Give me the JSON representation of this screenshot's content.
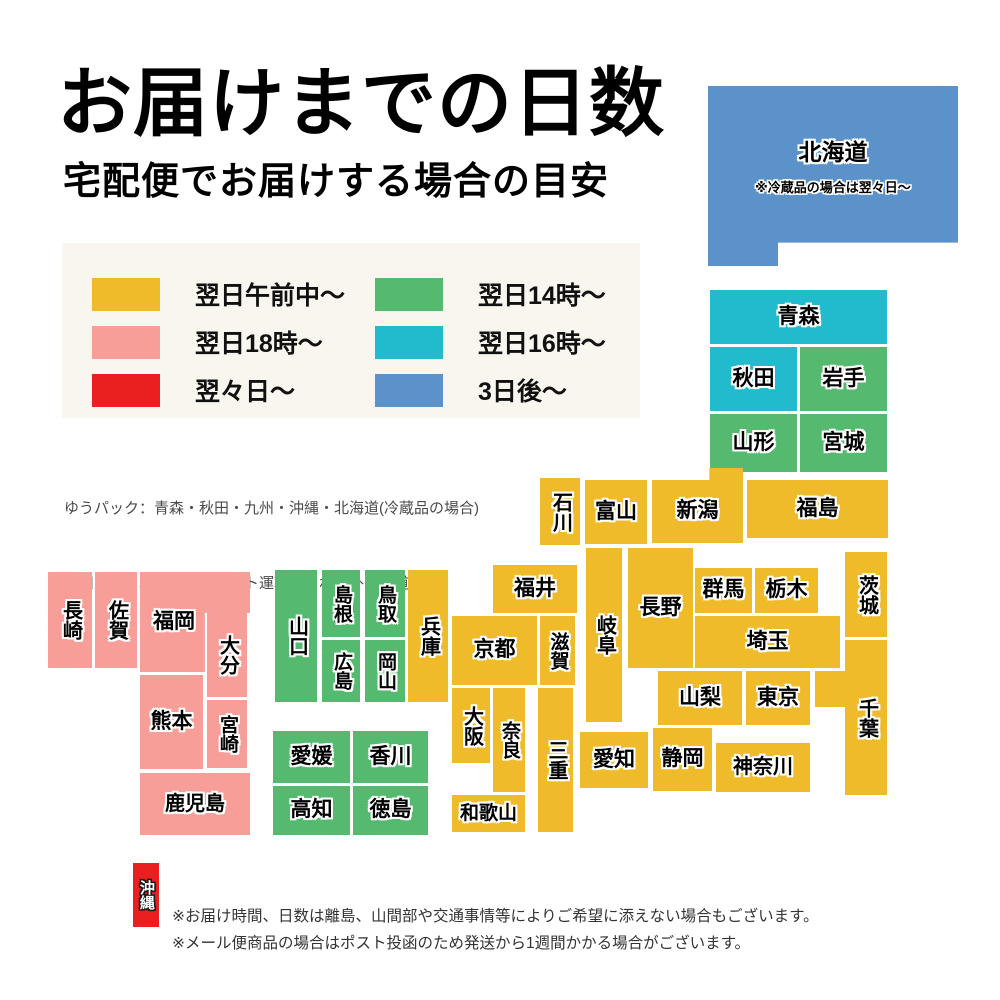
{
  "header": {
    "title": "お届けまでの日数",
    "subtitle": "宅配便でお届けする場合の目安"
  },
  "colors": {
    "yellow": "#EFBB2B",
    "pink": "#F79E99",
    "red": "#E9201F",
    "green": "#55BA6F",
    "cyan": "#22BACD",
    "blue": "#5B92C9",
    "legend_bg": "#F8F6EE"
  },
  "legend": {
    "items": [
      {
        "id": "next-day-morning",
        "label": "翌日午前中〜",
        "color": "yellow"
      },
      {
        "id": "next-day-18",
        "label": "翌日18時〜",
        "color": "pink"
      },
      {
        "id": "two-days-later",
        "label": "翌々日〜",
        "color": "red"
      },
      {
        "id": "next-day-14",
        "label": "翌日14時〜",
        "color": "green"
      },
      {
        "id": "next-day-16",
        "label": "翌日16時〜",
        "color": "cyan"
      },
      {
        "id": "three-days-later",
        "label": "3日後〜",
        "color": "blue"
      }
    ]
  },
  "carrier_notes": [
    "ゆうパック：青森・秋田・九州・沖縄・北海道(冷蔵品の場合)",
    "佐川急便：北海道　　ヤマト運輸：それ以外の都道府県"
  ],
  "map": {
    "tiles": [
      {
        "id": "hokkaido",
        "label": "北海道",
        "note": "※冷蔵品の場合は翌々日〜",
        "x": 708,
        "y": 86,
        "w": 250,
        "h": 180,
        "color": "blue",
        "orient": "h",
        "shape": "hokkaido",
        "font": 23
      },
      {
        "id": "aomori",
        "label": "青森",
        "x": 710,
        "y": 290,
        "w": 177,
        "h": 54,
        "color": "cyan",
        "orient": "h"
      },
      {
        "id": "akita",
        "label": "秋田",
        "x": 710,
        "y": 347,
        "w": 87,
        "h": 64,
        "color": "cyan",
        "orient": "h"
      },
      {
        "id": "iwate",
        "label": "岩手",
        "x": 800,
        "y": 347,
        "w": 87,
        "h": 64,
        "color": "green",
        "orient": "h"
      },
      {
        "id": "yamagata",
        "label": "山形",
        "x": 710,
        "y": 414,
        "w": 87,
        "h": 58,
        "color": "green",
        "orient": "h"
      },
      {
        "id": "miyagi",
        "label": "宮城",
        "x": 800,
        "y": 414,
        "w": 87,
        "h": 58,
        "color": "green",
        "orient": "h"
      },
      {
        "id": "ishikawa",
        "label": "石川",
        "x": 540,
        "y": 478,
        "w": 40,
        "h": 67,
        "color": "yellow",
        "orient": "v",
        "font": 20
      },
      {
        "id": "toyama",
        "label": "富山",
        "x": 585,
        "y": 480,
        "w": 62,
        "h": 64,
        "color": "yellow",
        "orient": "h"
      },
      {
        "id": "niigata",
        "label": "新潟",
        "x": 652,
        "y": 468,
        "w": 91,
        "h": 75,
        "color": "yellow",
        "orient": "h",
        "shape": "niigata"
      },
      {
        "id": "fukushima",
        "label": "福島",
        "x": 747,
        "y": 480,
        "w": 141,
        "h": 58,
        "color": "yellow",
        "orient": "h"
      },
      {
        "id": "gunma",
        "label": "群馬",
        "x": 695,
        "y": 568,
        "w": 57,
        "h": 45,
        "color": "yellow",
        "orient": "h"
      },
      {
        "id": "tochigi",
        "label": "栃木",
        "x": 755,
        "y": 568,
        "w": 63,
        "h": 45,
        "color": "yellow",
        "orient": "h"
      },
      {
        "id": "ibaraki",
        "label": "茨城",
        "x": 845,
        "y": 552,
        "w": 42,
        "h": 85,
        "color": "yellow",
        "orient": "v",
        "font": 20
      },
      {
        "id": "saitama",
        "label": "埼玉",
        "x": 695,
        "y": 616,
        "w": 145,
        "h": 52,
        "color": "yellow",
        "orient": "h"
      },
      {
        "id": "yamanashi",
        "label": "山梨",
        "x": 658,
        "y": 671,
        "w": 84,
        "h": 54,
        "color": "yellow",
        "orient": "h"
      },
      {
        "id": "tokyo",
        "label": "東京",
        "x": 746,
        "y": 671,
        "w": 64,
        "h": 54,
        "color": "yellow",
        "orient": "h"
      },
      {
        "id": "tokyo-bay-block",
        "label": "",
        "x": 815,
        "y": 671,
        "w": 30,
        "h": 36,
        "color": "yellow",
        "orient": "h"
      },
      {
        "id": "chiba",
        "label": "千葉",
        "x": 845,
        "y": 640,
        "w": 42,
        "h": 155,
        "color": "yellow",
        "orient": "v",
        "font": 20
      },
      {
        "id": "kanagawa",
        "label": "神奈川",
        "x": 716,
        "y": 743,
        "w": 94,
        "h": 49,
        "color": "yellow",
        "orient": "h",
        "font": 20
      },
      {
        "id": "nagano",
        "label": "長野",
        "x": 628,
        "y": 548,
        "w": 65,
        "h": 120,
        "color": "yellow",
        "orient": "h"
      },
      {
        "id": "gifu",
        "label": "岐阜",
        "x": 586,
        "y": 548,
        "w": 36,
        "h": 174,
        "color": "yellow",
        "orient": "v",
        "font": 20
      },
      {
        "id": "fukui",
        "label": "福井",
        "x": 493,
        "y": 565,
        "w": 84,
        "h": 48,
        "color": "yellow",
        "orient": "h"
      },
      {
        "id": "kyoto",
        "label": "京都",
        "x": 452,
        "y": 616,
        "w": 85,
        "h": 69,
        "color": "yellow",
        "orient": "h"
      },
      {
        "id": "shiga",
        "label": "滋賀",
        "x": 540,
        "y": 616,
        "w": 35,
        "h": 69,
        "color": "yellow",
        "orient": "v",
        "font": 19
      },
      {
        "id": "hyogo",
        "label": "兵庫",
        "x": 408,
        "y": 570,
        "w": 40,
        "h": 132,
        "color": "yellow",
        "orient": "v",
        "font": 20
      },
      {
        "id": "osaka",
        "label": "大阪",
        "x": 452,
        "y": 688,
        "w": 38,
        "h": 75,
        "color": "yellow",
        "orient": "v",
        "font": 20
      },
      {
        "id": "nara",
        "label": "奈良",
        "x": 493,
        "y": 688,
        "w": 32,
        "h": 104,
        "color": "yellow",
        "orient": "v",
        "font": 19
      },
      {
        "id": "mie",
        "label": "三重",
        "x": 538,
        "y": 688,
        "w": 35,
        "h": 144,
        "color": "yellow",
        "orient": "v",
        "font": 20
      },
      {
        "id": "wakayama",
        "label": "和歌山",
        "x": 452,
        "y": 795,
        "w": 73,
        "h": 37,
        "color": "yellow",
        "orient": "h",
        "font": 19
      },
      {
        "id": "aichi",
        "label": "愛知",
        "x": 580,
        "y": 732,
        "w": 68,
        "h": 56,
        "color": "yellow",
        "orient": "h"
      },
      {
        "id": "shizuoka",
        "label": "静岡",
        "x": 653,
        "y": 728,
        "w": 59,
        "h": 63,
        "color": "yellow",
        "orient": "h"
      },
      {
        "id": "shimane",
        "label": "島根",
        "x": 322,
        "y": 570,
        "w": 38,
        "h": 67,
        "color": "green",
        "orient": "v",
        "font": 19
      },
      {
        "id": "tottori",
        "label": "鳥取",
        "x": 365,
        "y": 570,
        "w": 40,
        "h": 67,
        "color": "green",
        "orient": "v",
        "font": 19
      },
      {
        "id": "hiroshima",
        "label": "広島",
        "x": 322,
        "y": 640,
        "w": 38,
        "h": 62,
        "color": "green",
        "orient": "v",
        "font": 19
      },
      {
        "id": "okayama",
        "label": "岡山",
        "x": 365,
        "y": 640,
        "w": 40,
        "h": 62,
        "color": "green",
        "orient": "v",
        "font": 19
      },
      {
        "id": "yamaguchi",
        "label": "山口",
        "x": 275,
        "y": 570,
        "w": 42,
        "h": 132,
        "color": "green",
        "orient": "v",
        "font": 20
      },
      {
        "id": "ehime",
        "label": "愛媛",
        "x": 273,
        "y": 731,
        "w": 77,
        "h": 52,
        "color": "green",
        "orient": "h"
      },
      {
        "id": "kagawa",
        "label": "香川",
        "x": 353,
        "y": 731,
        "w": 75,
        "h": 52,
        "color": "green",
        "orient": "h"
      },
      {
        "id": "kochi",
        "label": "高知",
        "x": 273,
        "y": 786,
        "w": 77,
        "h": 49,
        "color": "green",
        "orient": "h"
      },
      {
        "id": "tokushima",
        "label": "徳島",
        "x": 353,
        "y": 786,
        "w": 75,
        "h": 49,
        "color": "green",
        "orient": "h"
      },
      {
        "id": "nagasaki",
        "label": "長崎",
        "x": 48,
        "y": 572,
        "w": 44,
        "h": 96,
        "color": "pink",
        "orient": "v",
        "font": 20
      },
      {
        "id": "saga",
        "label": "佐賀",
        "x": 95,
        "y": 572,
        "w": 42,
        "h": 96,
        "color": "pink",
        "orient": "v",
        "font": 20
      },
      {
        "id": "fukuoka",
        "label": "福岡",
        "x": 140,
        "y": 572,
        "w": 110,
        "h": 100,
        "color": "pink",
        "orient": "h",
        "shape": "fukuoka"
      },
      {
        "id": "oita",
        "label": "大分",
        "x": 207,
        "y": 613,
        "w": 40,
        "h": 84,
        "color": "pink",
        "orient": "v",
        "font": 20
      },
      {
        "id": "kumamoto",
        "label": "熊本",
        "x": 140,
        "y": 675,
        "w": 63,
        "h": 94,
        "color": "pink",
        "orient": "h"
      },
      {
        "id": "miyazaki",
        "label": "宮崎",
        "x": 207,
        "y": 700,
        "w": 40,
        "h": 68,
        "color": "pink",
        "orient": "v",
        "font": 19
      },
      {
        "id": "kagoshima",
        "label": "鹿児島",
        "x": 140,
        "y": 773,
        "w": 110,
        "h": 62,
        "color": "pink",
        "orient": "h",
        "font": 20
      },
      {
        "id": "okinawa",
        "label": "沖縄",
        "x": 133,
        "y": 863,
        "w": 26,
        "h": 64,
        "color": "red",
        "orient": "v",
        "font": 15,
        "white_text": true
      }
    ]
  },
  "footer_notes": [
    "※お届け時間、日数は離島、山間部や交通事情等によりご希望に添えない場合もございます。",
    "※メール便商品の場合はポスト投函のため発送から1週間かかる場合がございます。"
  ]
}
